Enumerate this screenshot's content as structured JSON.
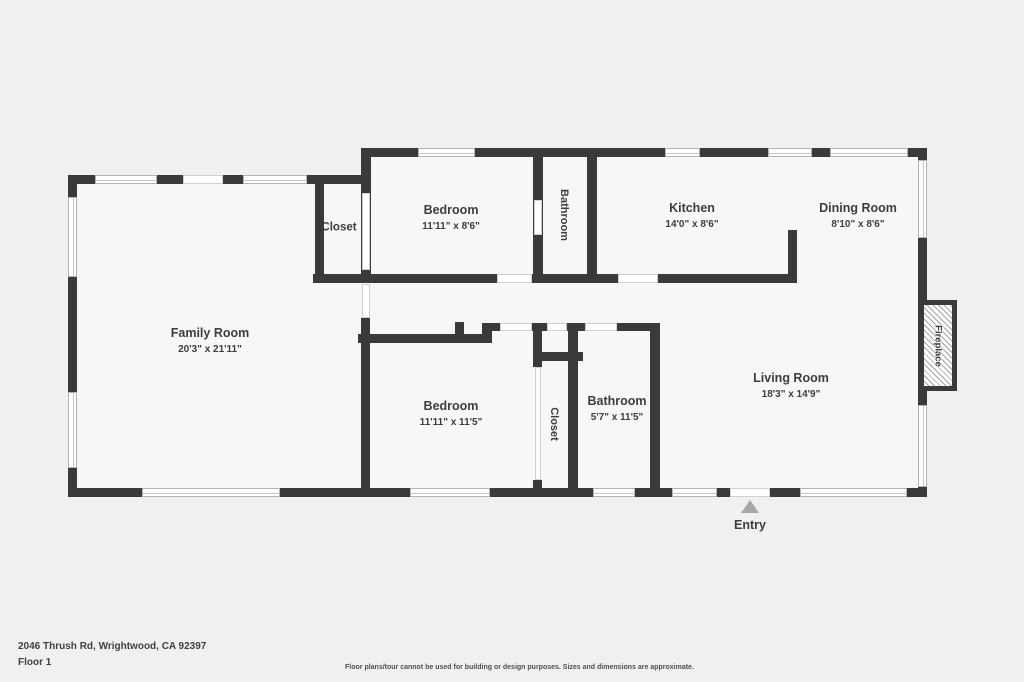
{
  "address": "2046 Thrush Rd, Wrightwood, CA 92397",
  "floor_label": "Floor 1",
  "disclaimer": "Floor plans/tour cannot be used for building or design purposes. Sizes and dimensions are approximate.",
  "entry": {
    "label": "Entry"
  },
  "colors": {
    "wall": "#3a3a3a",
    "background": "#f0f0f0",
    "room_fill": "#f7f7f7",
    "window": "#ffffff",
    "text": "#3d3d3d",
    "entry_arrow": "#a8a8a8"
  },
  "rooms": {
    "family_room": {
      "name": "Family Room",
      "dims": "20'3\" x 21'11\""
    },
    "closet_top": {
      "name": "Closet"
    },
    "bedroom_top": {
      "name": "Bedroom",
      "dims": "11'11\" x 8'6\""
    },
    "bathroom_top": {
      "name": "Bathroom"
    },
    "kitchen": {
      "name": "Kitchen",
      "dims": "14'0\" x 8'6\""
    },
    "dining_room": {
      "name": "Dining Room",
      "dims": "8'10\" x 8'6\""
    },
    "bedroom_bottom": {
      "name": "Bedroom",
      "dims": "11'11\" x 11'5\""
    },
    "closet_bottom": {
      "name": "Closet"
    },
    "bathroom_bottom": {
      "name": "Bathroom",
      "dims": "5'7\" x 11'5\""
    },
    "living_room": {
      "name": "Living Room",
      "dims": "18'3\" x 14'9\""
    },
    "fireplace": {
      "name": "Fireplace"
    }
  }
}
